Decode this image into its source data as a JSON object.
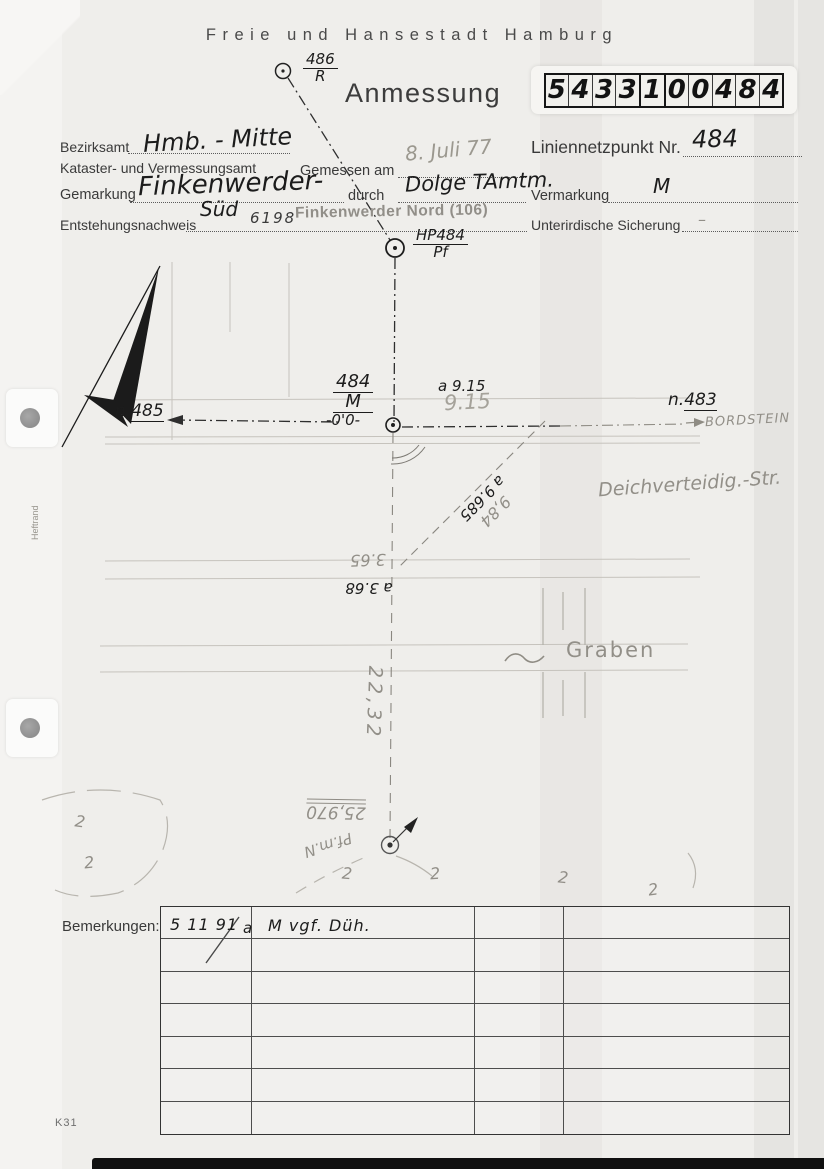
{
  "palette": {
    "paper": "#efeeeb",
    "ink": "#1c1c1c",
    "pencil": "#928f88",
    "faint_line": "#c6c3bd",
    "print": "#3a3a3a"
  },
  "header": {
    "city": "Freie und Hansestadt Hamburg",
    "title": "Anmessung",
    "doc_number": {
      "digits": [
        "5",
        "4",
        "3",
        "3",
        "1",
        "0",
        "0",
        "4",
        "8",
        "4"
      ]
    }
  },
  "form": {
    "bezirksamt_label": "Bezirksamt",
    "bezirksamt_value": "Hmb. - Mitte",
    "amt_label": "Kataster- und Vermessungsamt",
    "gemessen_label": "Gemessen am",
    "gemessen_value": "8. Juli 77",
    "liniennetzpunkt_label": "Liniennetzpunkt Nr.",
    "liniennetzpunkt_value": "484",
    "gemarkung_label": "Gemarkung",
    "gemarkung_value": "Finkenwerder-",
    "gemarkung_value2": "Süd",
    "durch_label": "durch",
    "durch_value": "Dolge TAmtm.",
    "vermarkung_label": "Vermarkung",
    "vermarkung_value": "M",
    "entstehung_label": "Entstehungsnachweis",
    "entstehung_value": "6198",
    "stamp": "Finkenwerder Nord (106)",
    "sicherung_label": "Unterirdische Sicherung",
    "sicherung_value": "–"
  },
  "sketch": {
    "point_top": {
      "num": "486",
      "den": "R"
    },
    "point_hp": {
      "num": "HP484",
      "den": "Pf"
    },
    "point_main": {
      "num": "484",
      "den": "M"
    },
    "n485": {
      "prefix": "n.",
      "num": "485"
    },
    "n483": {
      "prefix": "n.",
      "num": "483"
    },
    "bordstein": "BORDSTEIN",
    "zero_mark": "-0'0-",
    "a915_ink": "a 9.15",
    "p915_pencil": "9.15",
    "p984_pencil": "9,84",
    "a9685_ink": "a 9.685",
    "p365_pencil": "3.65",
    "a368_ink": "a 3.68",
    "street_name": "Deichverteidig.-Str.",
    "graben": "Graben",
    "dist_2232": "22,32",
    "p25970": "25,970",
    "pfmn": "Pf.m.N",
    "z_marks": [
      "2",
      "2",
      "2",
      "2",
      "2",
      "2"
    ]
  },
  "table": {
    "label": "Bemerkungen:",
    "row_count": 7,
    "col_count": 4,
    "row1": {
      "date": "5 11 91",
      "suffix": "a",
      "remark": "M vgf. Düh."
    }
  },
  "footer": {
    "form_code": "K31",
    "margin_label": "Heftrand"
  }
}
